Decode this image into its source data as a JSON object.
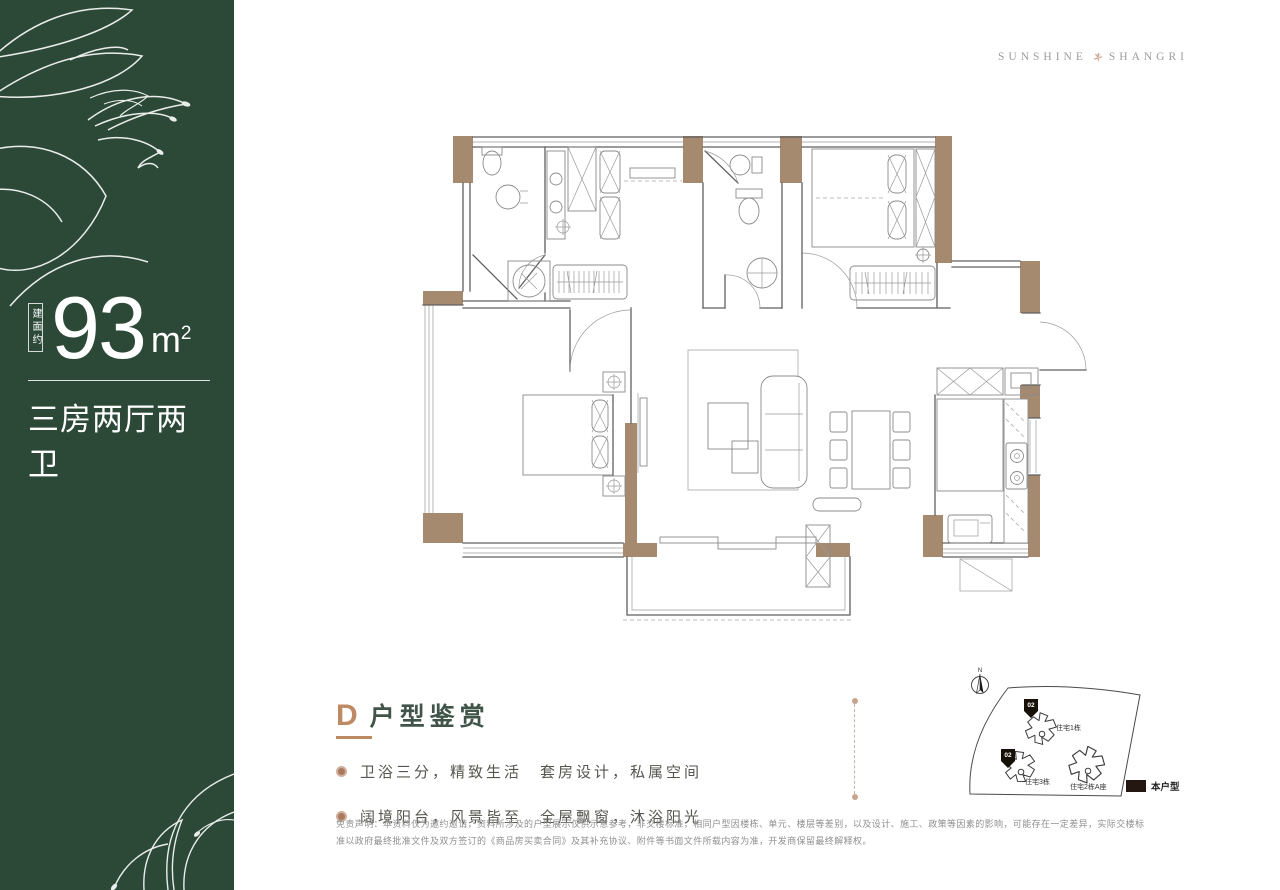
{
  "colors": {
    "green": "#2B4936",
    "wall": "#A58A6F",
    "accent": "#BE8A64",
    "title": "#41544A",
    "text": "#55564F",
    "muted": "#8F8F8F",
    "flower": "#C79480",
    "logotext": "#9C9C9C"
  },
  "sidebar": {
    "area_label": "建面约",
    "area_value": "93",
    "area_unit": "m",
    "area_unit_exp": "2",
    "layout": "三房两厅两卫"
  },
  "logo": {
    "left": "SUNSHINE",
    "right": "SHANGRI"
  },
  "feature": {
    "letter": "D",
    "title": "户型鉴赏",
    "bullets": [
      "卫浴三分，精致生活　套房设计，私属空间",
      "阔境阳台，风景皆至　全屋飘窗，沐浴阳光"
    ]
  },
  "siteplan": {
    "north": "N",
    "buildings": [
      {
        "name": "住宅1栋",
        "badge": "02"
      },
      {
        "name": "住宅3栋",
        "badge": "02"
      },
      {
        "name": "住宅2栋A座",
        "badge": ""
      }
    ],
    "legend": "本户型"
  },
  "disclaimer": "免责声明：本资料仅为邀约邀请，资料所涉及的户型展示仅供示意参考，非交楼标准，相同户型因楼栋、单元、楼层等差别，以及设计、施工、政策等因素的影响，可能存在一定差异，实际交楼标准以政府最终批准文件及双方签订的《商品房买卖合同》及其补充协议、附件等书面文件所载内容为准，开发商保留最终解释权。"
}
